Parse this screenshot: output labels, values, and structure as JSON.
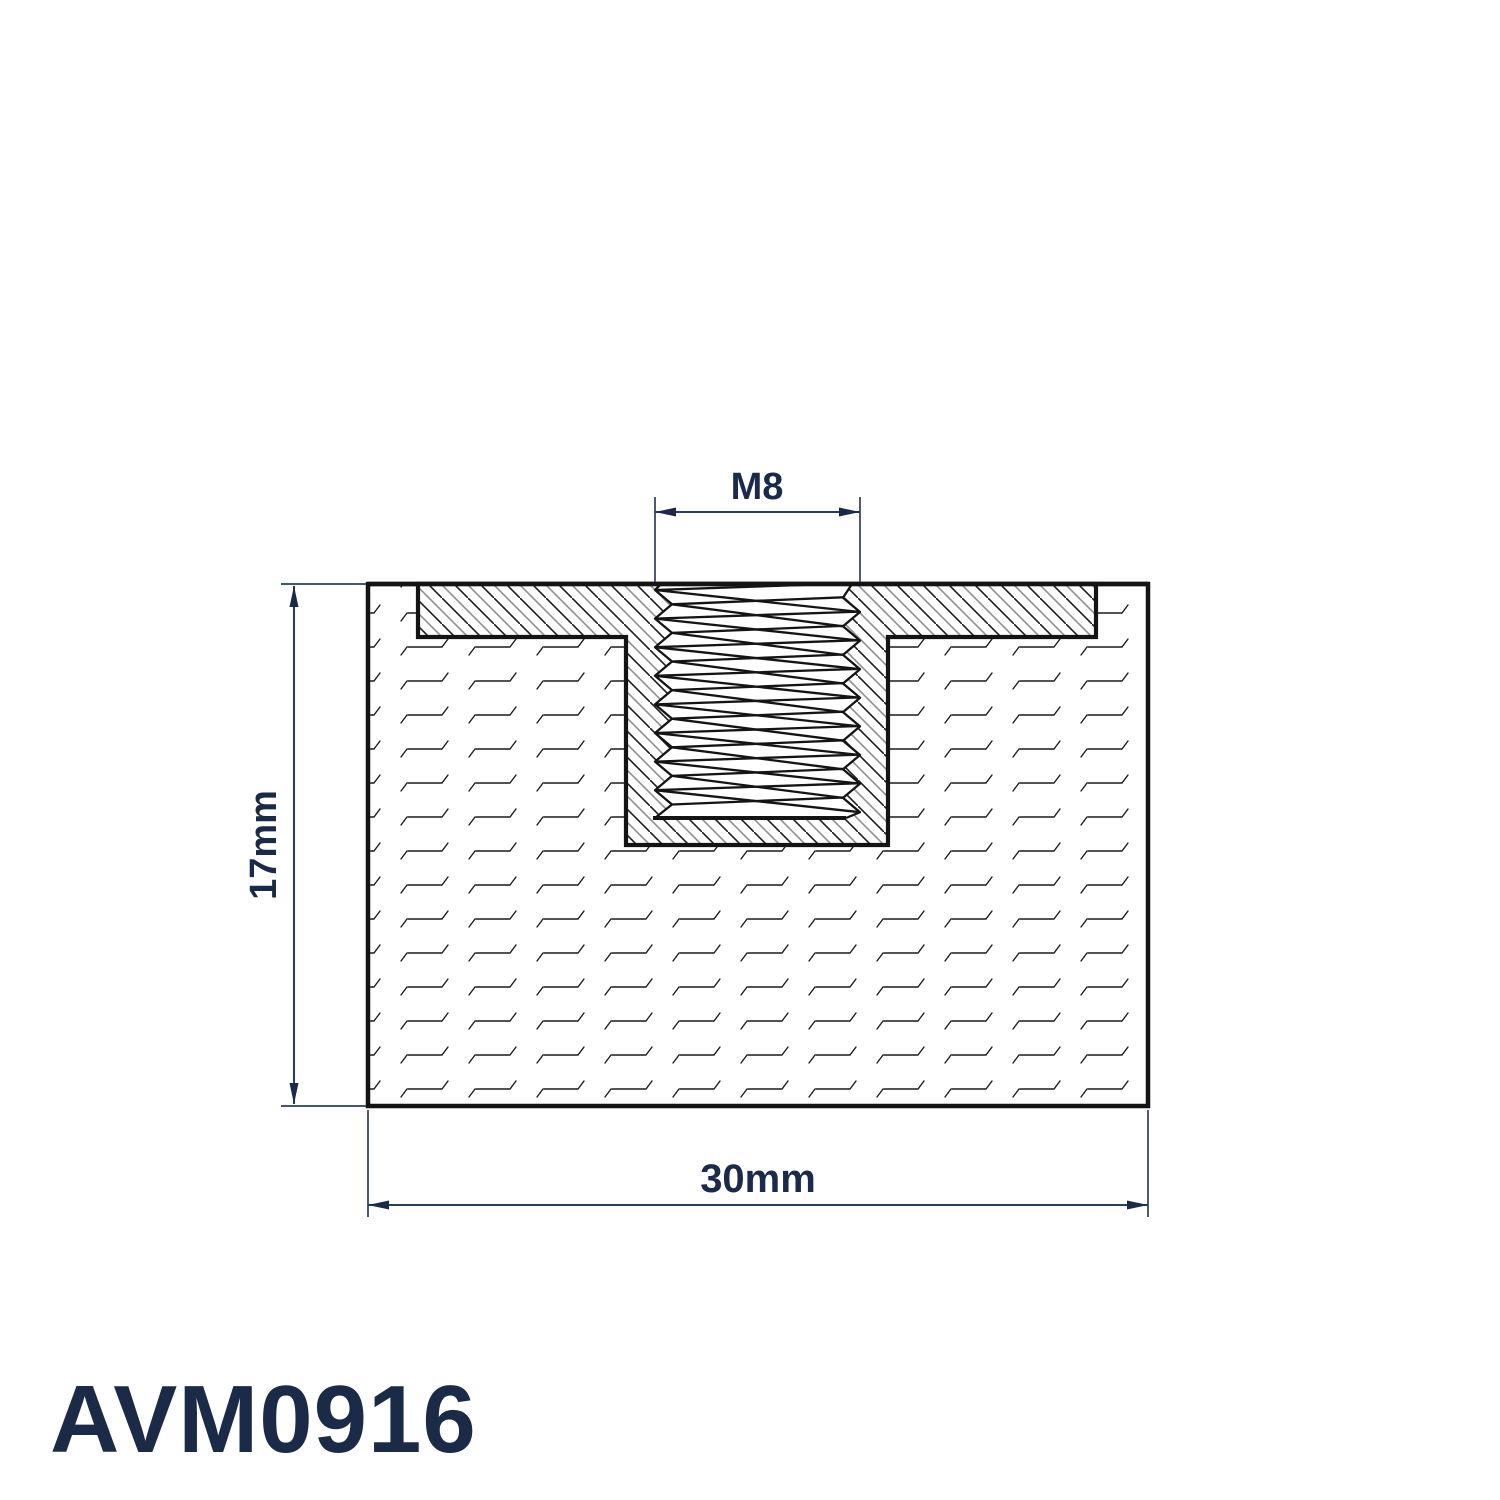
{
  "part": {
    "number": "AVM0916"
  },
  "dimensions": {
    "thread": "M8",
    "height": "17mm",
    "width": "30mm"
  },
  "colors": {
    "annotation": "#1b2a47",
    "dimension_line": "#2c3e5c",
    "outline": "#141414"
  }
}
